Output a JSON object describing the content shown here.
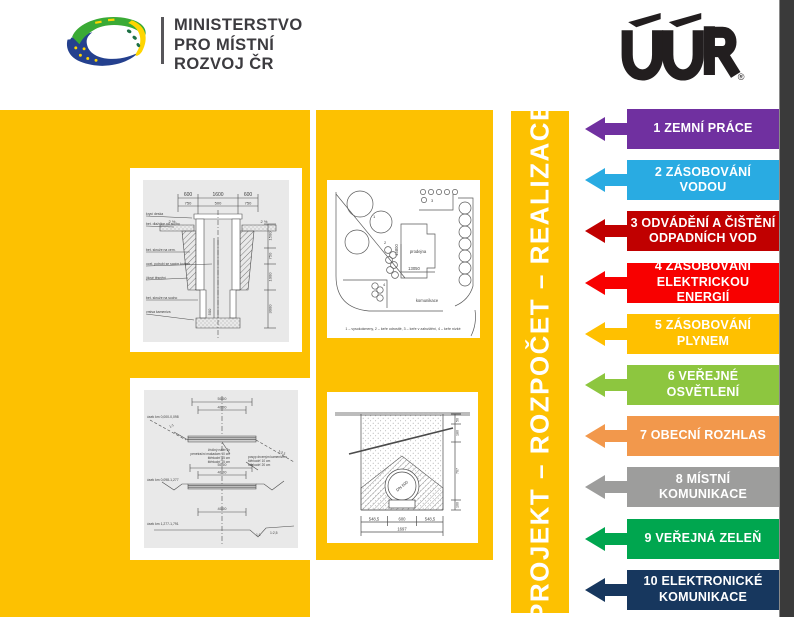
{
  "colors": {
    "yellow": "#FDC101",
    "edge": "#3A3A3A"
  },
  "header": {
    "ministry": {
      "title_lines": [
        "MINISTERSTVO",
        "PRO MÍSTNÍ",
        "ROZVOJ ČR"
      ]
    },
    "uur": {
      "text": "ÚÚR",
      "registered": "®"
    }
  },
  "strip": {
    "title": "PROJEKT – ROZPOČET – REALIZACE"
  },
  "categories": [
    {
      "label": "1 ZEMNÍ PRÁCE",
      "color": "#7030A0"
    },
    {
      "label": "2 ZÁSOBOVÁNÍ VODOU",
      "color": "#29ABE2"
    },
    {
      "label": "3 ODVÁDĚNÍ A ČIŠTĚNÍ ODPADNÍCH VOD",
      "color": "#C00000"
    },
    {
      "label": "4 ZÁSOBOVÁNÍ ELEKTRICKOU ENERGIÍ",
      "color": "#F80000"
    },
    {
      "label": "5 ZÁSOBOVÁNÍ PLYNEM",
      "color": "#FFC000"
    },
    {
      "label": "6 VEŘEJNÉ OSVĚTLENÍ",
      "color": "#8DC63F"
    },
    {
      "label": "7 OBECNÍ ROZHLAS",
      "color": "#F2984C"
    },
    {
      "label": "8 MÍSTNÍ KOMUNIKACE",
      "color": "#9D9D9C"
    },
    {
      "label": "9 VEŘEJNÁ ZELEŇ",
      "color": "#00A64F"
    },
    {
      "label": "10 ELEKTRONICKÉ KOMUNIKACE",
      "color": "#17375E"
    }
  ],
  "drawings": {
    "well": {
      "dims_top": [
        "600",
        "1600",
        "600"
      ],
      "dims_top2": [
        "750",
        "500",
        "750"
      ],
      "slope_left": "2 %",
      "slope_right": "2 %",
      "labels": [
        "krycí deska",
        "bet. dlaždice na sucho",
        "bet. skruže na cem.",
        "ocel. potrubí se sacím košem",
        "jílové těsnění",
        "bet. skruže na sucho",
        "vrstva kameniva"
      ],
      "dims_right": [
        "1500",
        "750",
        "1000",
        "3000"
      ],
      "dim_pipe": "500"
    },
    "siteplan": {
      "building": "prodejna",
      "dim_width": "13050",
      "dim_height": "15800",
      "road": "komunikace",
      "markers": [
        "1",
        "2",
        "3",
        "4"
      ],
      "legend": "1 – vysokokmeny, 2 – keře odrostlé, 3 – keře v zahuštění, 4 – keře nízké"
    },
    "road": {
      "sections": [
        "úsek km 0,000-0,098",
        "úsek km 0,098-1,277",
        "úsek km 1,277-1,791"
      ],
      "dim_5000": "5000",
      "dim_4000": "4000",
      "note_left": [
        "živičný nátěr 2x",
        "penetrační makadam 10 cm",
        "štěrkodrť 15 cm",
        "štěrkodrť 15 cm"
      ],
      "note_right": [
        "posyp drceným kamenivem",
        "štěrkodrť 10 cm",
        "štěrkodrť 20 cm"
      ],
      "slope_11": "1:1",
      "slope_125": "1:2,5"
    },
    "trench": {
      "dims_bottom": [
        "548,5",
        "600",
        "548,5"
      ],
      "dim_total": "1697",
      "dims_right": [
        "50",
        "180",
        "767",
        "100"
      ],
      "pipe": "DN 600"
    }
  }
}
